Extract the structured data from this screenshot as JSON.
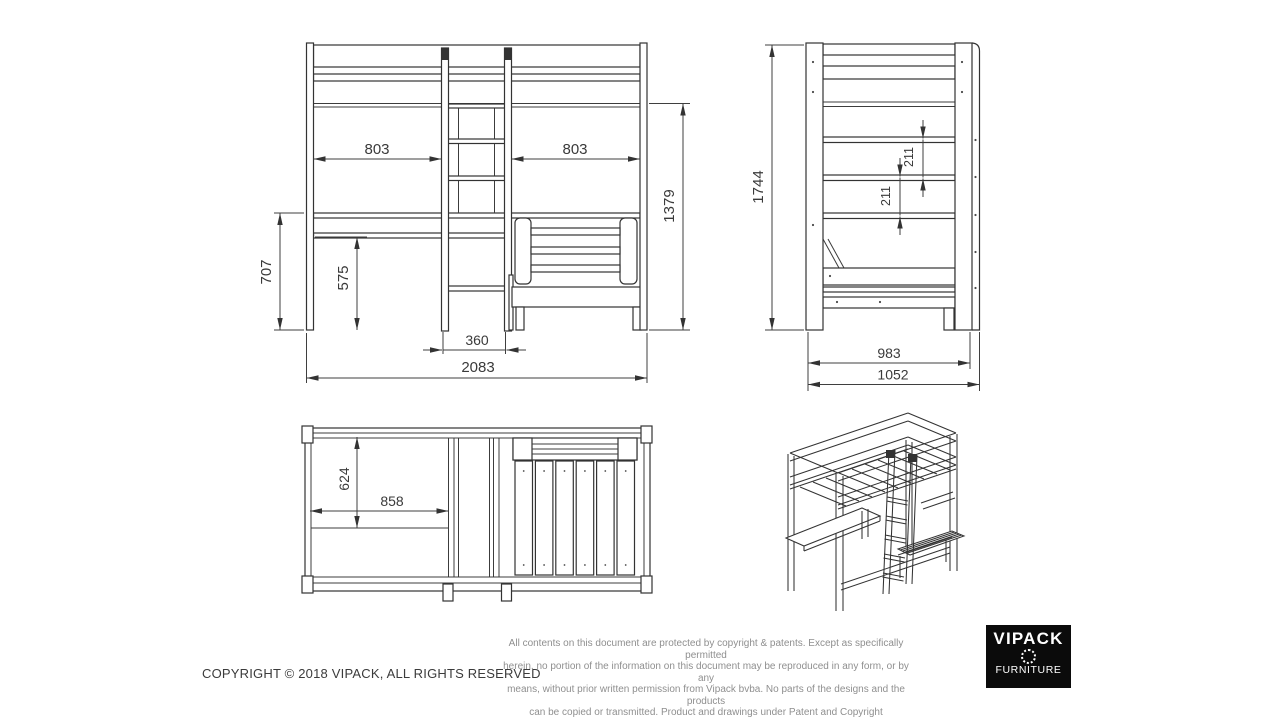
{
  "front_view": {
    "left_bay": "803",
    "right_bay": "803",
    "under_bed_height": "1379",
    "desk_height": "707",
    "desk_clearance": "575",
    "ladder_width": "360",
    "total_width": "2083"
  },
  "side_view": {
    "total_height": "1744",
    "upper_gap": "211",
    "lower_gap": "211",
    "frame_depth": "983",
    "total_depth": "1052"
  },
  "top_view": {
    "bed_depth": "624",
    "desk_width": "858"
  },
  "footer": {
    "copyright": "COPYRIGHT © 2018 VIPACK, ALL RIGHTS RESERVED",
    "disclaimer_lines": [
      "All contents on this document are protected by copyright & patents. Except as specifically permitted",
      "herein, no portion of the information on this document may be reproduced in any form, or by any",
      "means, without prior written permission from Vipack bvba. No parts of the designs and the products",
      "can be copied or transmitted. Product and drawings under Patent and Copyright"
    ],
    "logo": {
      "brand": "VIPACK",
      "subbrand": "FURNITURE"
    }
  }
}
